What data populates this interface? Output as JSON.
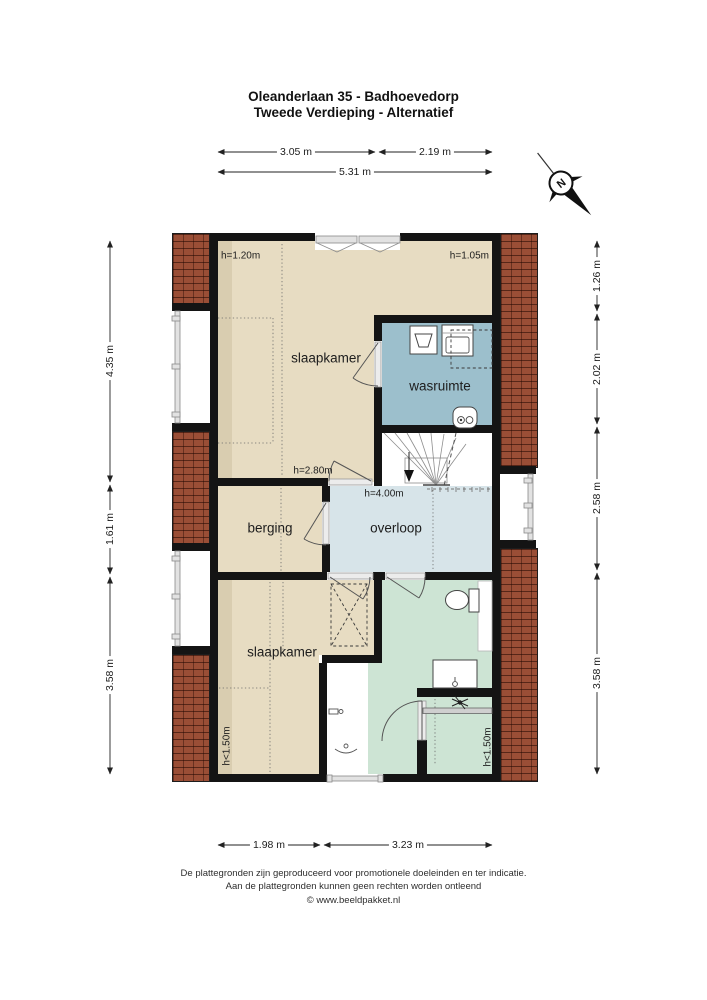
{
  "title": {
    "line1": "Oleanderlaan 35 - Badhoevedorp",
    "line2": "Tweede Verdieping - Alternatief"
  },
  "compass": {
    "north_label": "N"
  },
  "dimensions": {
    "top_segments": [
      "3.05 m",
      "2.19 m"
    ],
    "top_total": "5.31 m",
    "left": [
      "4.35 m",
      "1.61 m",
      "3.58 m"
    ],
    "right": [
      "1.26 m",
      "2.02 m",
      "2.58 m",
      "3.58 m"
    ],
    "bottom": [
      "1.98 m",
      "3.23 m"
    ]
  },
  "rooms": {
    "slaapkamer_top": {
      "label": "slaapkamer",
      "height_left": "h=1.20m",
      "height_right": "h=1.05m",
      "height_door": "h=2.80m"
    },
    "wasruimte": {
      "label": "wasruimte"
    },
    "berging": {
      "label": "berging"
    },
    "overloop": {
      "label": "overloop",
      "height": "h=4.00m"
    },
    "slaapkamer_bottom": {
      "label": "slaapkamer",
      "height_edge": "h<1.50m"
    },
    "badkamer": {
      "height_edge": "h<1.50m"
    }
  },
  "colors": {
    "room-beige": "#e7dcc2",
    "room-beige-dark": "#d9cdb0",
    "room-blue": "#9cbfcc",
    "room-lightblue": "#d7e4e9",
    "room-green": "#cde4d4",
    "roof": "#9a4e36",
    "wall": "#141414"
  },
  "footer": {
    "line1": "De plattegronden zijn geproduceerd voor promotionele doeleinden en ter indicatie.",
    "line2": "Aan de plattegronden kunnen geen rechten worden ontleend",
    "line3": "© www.beeldpakket.nl"
  }
}
